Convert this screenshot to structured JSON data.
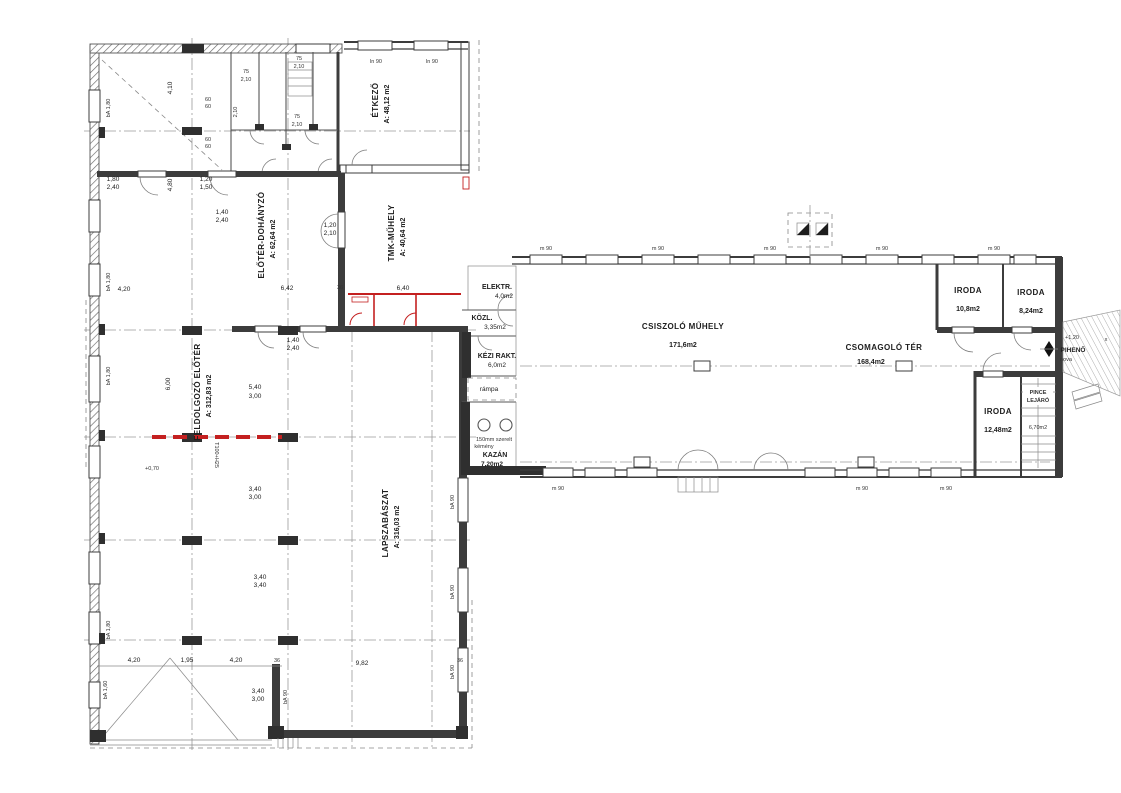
{
  "rooms": {
    "etkezo": {
      "name": "ÉTKEZŐ",
      "area": "A: 48,12 m2"
    },
    "eloter": {
      "name": "ELŐTÉR-DOHÁNYZÓ",
      "area": "A: 62,64 m2"
    },
    "tmk": {
      "name": "TMK-MŰHELY",
      "area": "A: 40,64 m2"
    },
    "feldolgozo": {
      "name": "FELDOLGOZÓ ELŐTÉR",
      "area": "A: 312,83 m2"
    },
    "lapszabaszat": {
      "name": "LAPSZABÁSZAT",
      "area": "A: 316,03 m2"
    },
    "elektr": {
      "name": "ELEKTR.",
      "area": "4,0m2"
    },
    "kozl": {
      "name": "KÖZL.",
      "area": "3,35m2"
    },
    "kezi": {
      "name": "KÉZI RAKT.",
      "area": "6,0m2"
    },
    "kazan": {
      "name": "KAZÁN",
      "area": "7,20m2",
      "note1": "150mm szerelt",
      "note2": "kémény"
    },
    "csiszolo": {
      "name": "CSISZOLÓ MŰHELY",
      "area": "171,6m2"
    },
    "csomagolo": {
      "name": "CSOMAGOLÓ TÉR",
      "area": "168,4m2"
    },
    "iroda_a": {
      "name": "IRODA",
      "area": "10,8m2"
    },
    "iroda_b": {
      "name": "IRODA",
      "area": "8,24m2"
    },
    "iroda_c": {
      "name": "IRODA",
      "area": "12,48m2"
    },
    "pince": {
      "line1": "PINCE",
      "line2": "LEJÁRÓ",
      "area": "6,70m2"
    },
    "piheno": {
      "name": "PIHENŐ",
      "sub": "nova"
    },
    "rampa": {
      "name": "rámpa"
    }
  },
  "dims": {
    "d420": "4,20",
    "d410": "4,10",
    "d480": "4,80",
    "d600": "6,00",
    "d540": "5,40",
    "d642": "6,42",
    "d640": "6,40",
    "d36": "36",
    "d982": "9,82",
    "d195": "1,95",
    "d340": "3,40",
    "d300": "3,00",
    "d180": "1,80",
    "d240": "2,40",
    "d120": "1,20",
    "d150": "1,50",
    "d210": "2,10",
    "d140": "1,40",
    "d75": "75",
    "d60": "60",
    "ba180": "bA 1,80",
    "ba160": "bA 1,60",
    "ba90": "bA 90",
    "ln90": "ln 90",
    "m90": "m 90",
    "t100": "T100+H25",
    "lvl070": "+0,70",
    "lvl120": "+1,20",
    "xmark": "x"
  },
  "colors": {
    "wall": "#3c3c3c",
    "thin": "#8a8a8a",
    "grid": "#9b9b9b",
    "red": "#c42020",
    "ink": "#1d1d1d"
  }
}
